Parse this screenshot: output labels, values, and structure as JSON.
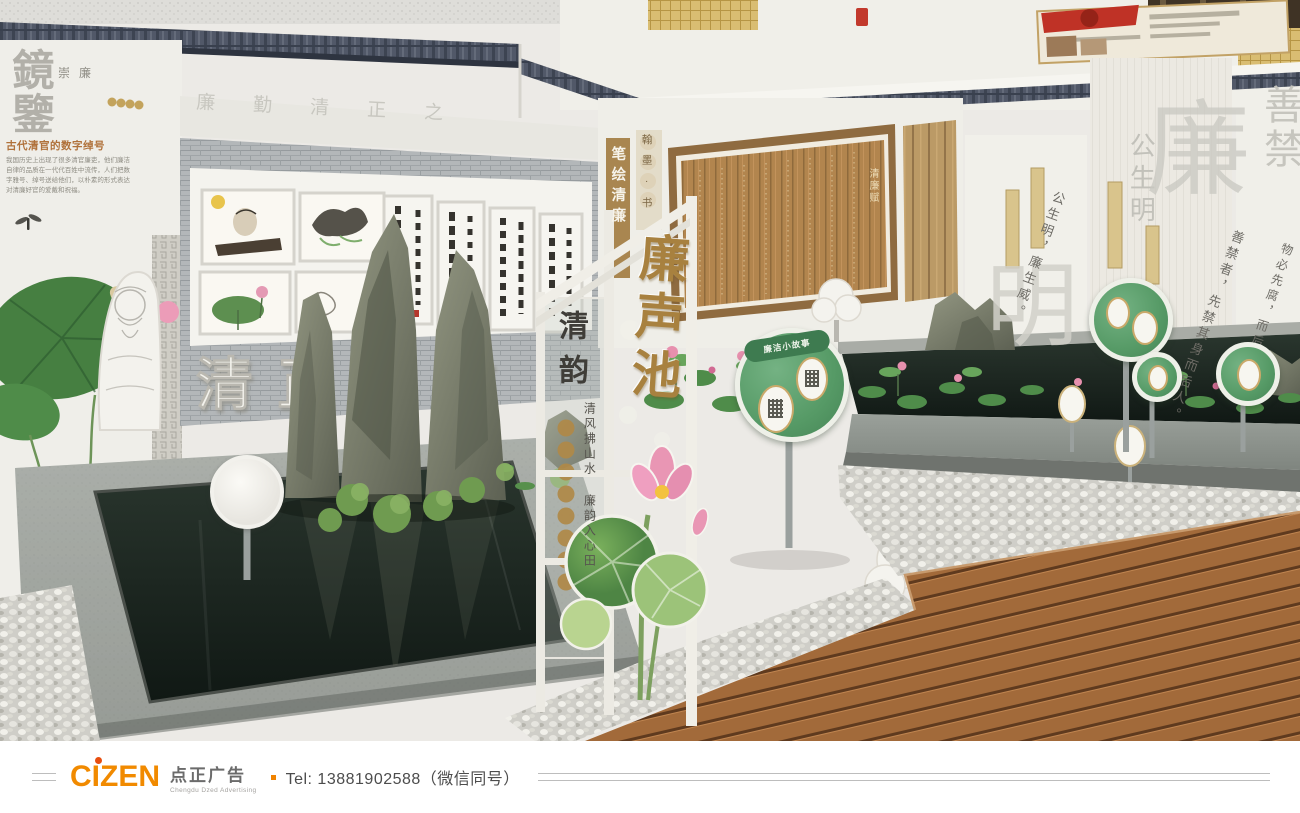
{
  "scene": {
    "left_wall": {
      "title": "鏡鑒",
      "subtitle": "崇廉",
      "heading": "古代清官的数字绰号",
      "paragraph": "我国历史上出现了很多清官廉吏，他们廉洁自律的品质在一代代百姓中流传，人们把数字雅号、绰号送给他们，以朴素的形式表达对清廉好官的爱戴和祝福。"
    },
    "frieze_text": "廉 勤 清 正 之",
    "brick_wall": {
      "slogan_3d": "清正廉洁"
    },
    "center_wall": {
      "strip_title": "笔绘清廉",
      "strip_tag": "翰墨·书",
      "bamboo_panel_title": "清廉赋"
    },
    "gate": {
      "sign": "廉声池"
    },
    "glass_panel": {
      "title": "清韵",
      "slogan": "清风拂山水 廉韵入心田"
    },
    "right_wall": {
      "watermarks": [
        "公生明",
        "明",
        "廉",
        "善禁"
      ],
      "quotes": [
        "公生明，廉生威。",
        "善禁者，先禁其身而后人。",
        "物必先腐，而后虫生。"
      ]
    },
    "pond_sign": {
      "label": "廉洁小故事"
    }
  },
  "footer": {
    "brand": "CIZEN",
    "brand_cn": "点正广告",
    "brand_en": "Chengdu Dzed Advertising",
    "tel": "Tel: 13881902588（微信同号）"
  },
  "colors": {
    "accent_orange": "#f08300",
    "sign_green": "#5aa06c",
    "gold": "#a8813f",
    "roof": "#4f5663",
    "water": "#18211d",
    "wood": "#a06b3f"
  }
}
